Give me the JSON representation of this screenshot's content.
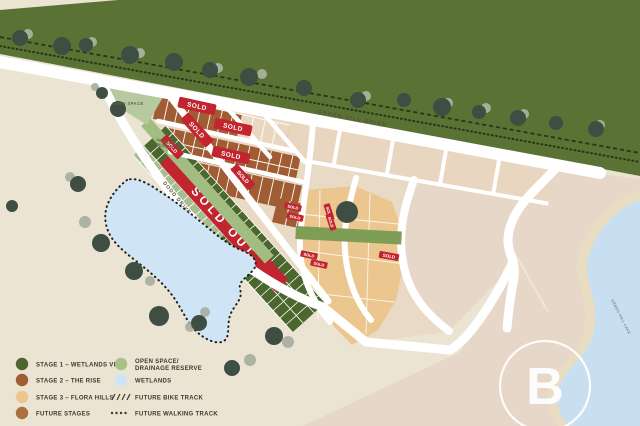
{
  "legend": {
    "col1": [
      {
        "label": "STAGE 1 – WETLANDS VIEW",
        "color": "#4c672d"
      },
      {
        "label": "STAGE 2 – THE RISE",
        "color": "#a05d34"
      },
      {
        "label": "STAGE 3 – FLORA HILLS",
        "color": "#ecc68f"
      },
      {
        "label": "FUTURE STAGES",
        "color": "#a8713f"
      }
    ],
    "col2": [
      {
        "label": "OPEN SPACE/",
        "label2": "DRAINAGE RESERVE",
        "color": "#a9c186"
      },
      {
        "label": "WETLANDS",
        "color": "#cfe4f5"
      },
      {
        "label": "FUTURE BIKE TRACK"
      },
      {
        "label": "FUTURE WALKING TRACK"
      }
    ]
  },
  "streets": {
    "green_hill_drive": "GREEN HILL DRIVE",
    "dodd_drive": "DODD DRIVE"
  },
  "areas": {
    "open_space": "OPEN SPACE",
    "drainage_reserve_line1": "DRAINAGE",
    "drainage_reserve_line2": "RESERVE",
    "lake": "GREEN HILL LAKE"
  },
  "banners": {
    "sold_out": "SOLD OUT",
    "sold": "SOLD"
  },
  "logo": {
    "letter": "B"
  },
  "colors": {
    "stage1": "#4c672d",
    "stage1_light": "#a8bd8d",
    "stage2": "#a05d34",
    "stage3": "#ecc68f",
    "sold_red": "#c2252f",
    "wetlands": "#cfe4f5",
    "reserve_green": "#5a7233",
    "open_space_green": "#b7c99e",
    "corridor_green": "#7f9e55",
    "background": "#ece4d3",
    "future_pink": "#e7d7c8",
    "road": "#ffffff"
  }
}
